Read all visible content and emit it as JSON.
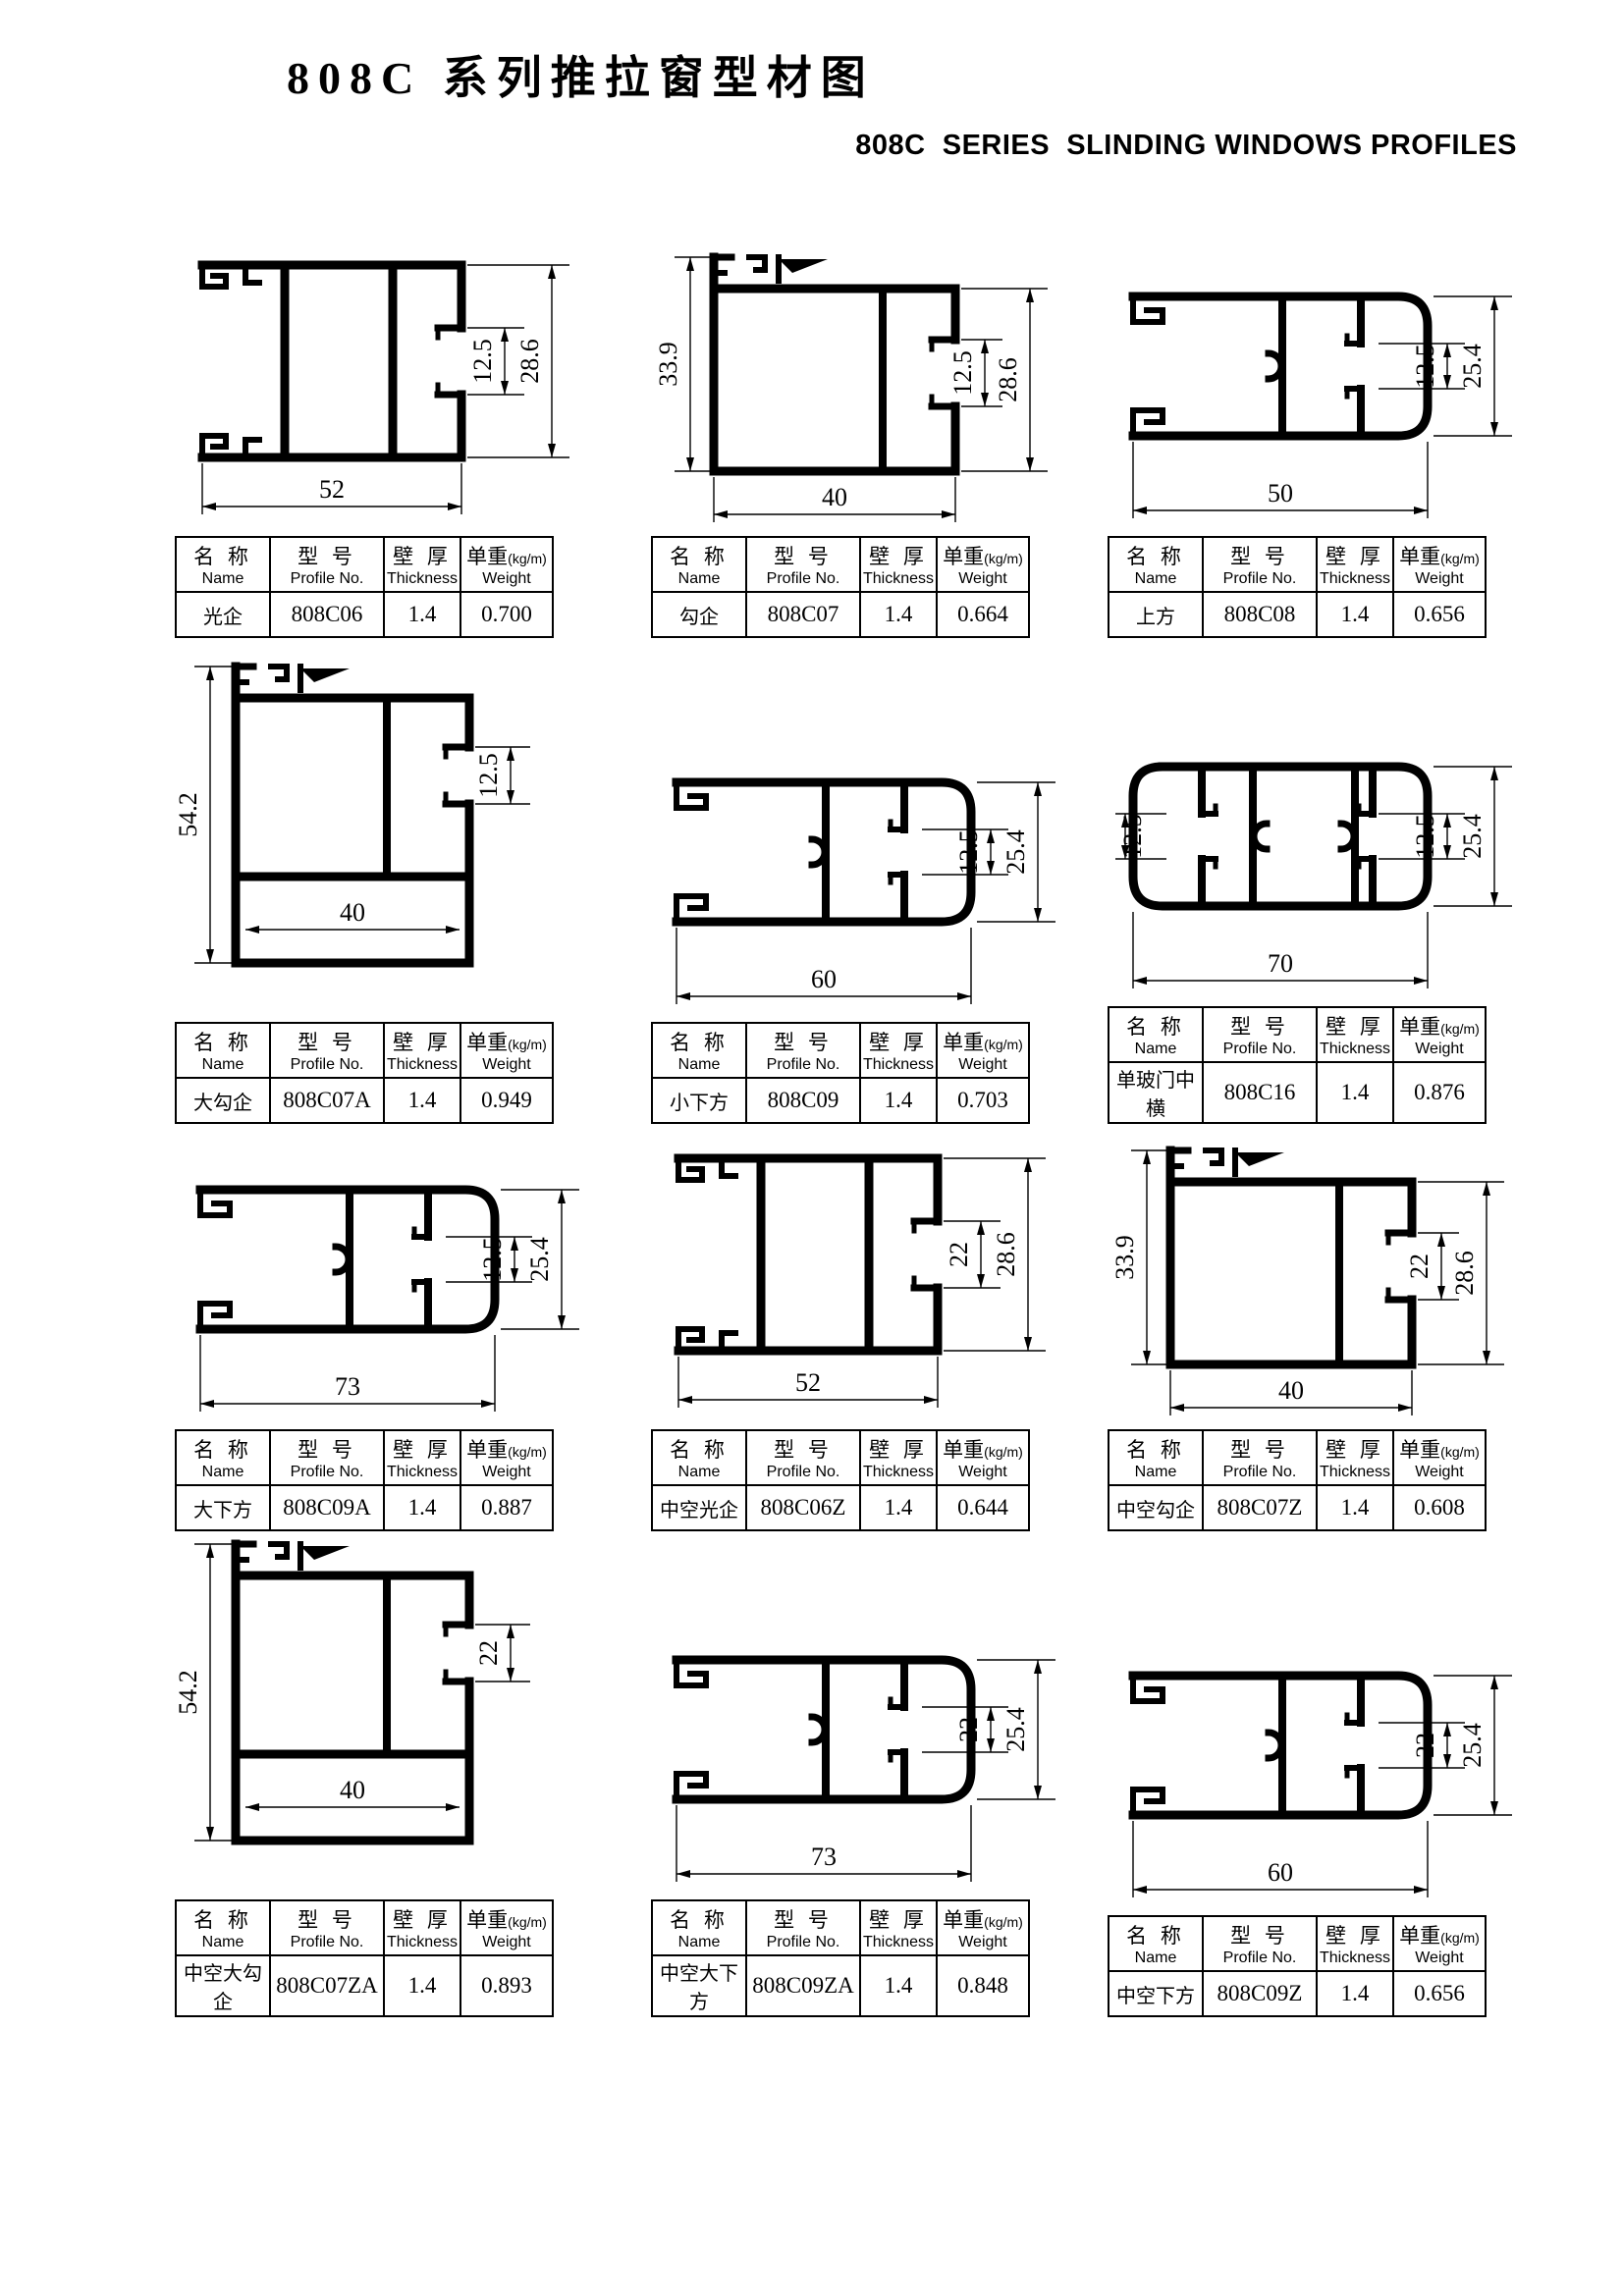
{
  "page": {
    "title": "808C 系列推拉窗型材图",
    "subtitle": "808C  SERIES  SLINDING WINDOWS PROFILES"
  },
  "table_headers": {
    "name_cn": "名 称",
    "name_en": "Name",
    "profile_cn": "型 号",
    "profile_en": "Profile No.",
    "thickness_cn": "壁 厚",
    "thickness_en": "Thickness",
    "weight_cn": "单重",
    "weight_unit": "(kg/m)",
    "weight_en": "Weight"
  },
  "profiles": [
    {
      "name": "光企",
      "profile_no": "808C06",
      "thickness": "1.4",
      "weight": "0.700",
      "shape": "frame",
      "dims": {
        "bottom": "52",
        "right_inner": "12.5",
        "right_outer": "28.6"
      }
    },
    {
      "name": "勾企",
      "profile_no": "808C07",
      "thickness": "1.4",
      "weight": "0.664",
      "shape": "hook-frame",
      "dims": {
        "left": "33.9",
        "bottom": "40",
        "right_inner": "12.5",
        "right_outer": "28.6"
      }
    },
    {
      "name": "上方",
      "profile_no": "808C08",
      "thickness": "1.4",
      "weight": "0.656",
      "shape": "rail",
      "dims": {
        "bottom": "50",
        "right_inner": "12.5",
        "right_outer": "25.4"
      }
    },
    {
      "name": "大勾企",
      "profile_no": "808C07A",
      "thickness": "1.4",
      "weight": "0.949",
      "shape": "tall-hook-frame",
      "dims": {
        "left": "54.2",
        "inner": "12.5",
        "bottom": "40"
      }
    },
    {
      "name": "小下方",
      "profile_no": "808C09",
      "thickness": "1.4",
      "weight": "0.703",
      "shape": "rail",
      "dims": {
        "bottom": "60",
        "right_inner": "12.5",
        "right_outer": "25.4"
      }
    },
    {
      "name": "单玻门中横",
      "profile_no": "808C16",
      "thickness": "1.4",
      "weight": "0.876",
      "shape": "rail-double",
      "dims": {
        "left": "12.5",
        "bottom": "70",
        "right_inner": "12.5",
        "right_outer": "25.4"
      }
    },
    {
      "name": "大下方",
      "profile_no": "808C09A",
      "thickness": "1.4",
      "weight": "0.887",
      "shape": "rail",
      "dims": {
        "bottom": "73",
        "right_inner": "12.5",
        "right_outer": "25.4"
      }
    },
    {
      "name": "中空光企",
      "profile_no": "808C06Z",
      "thickness": "1.4",
      "weight": "0.644",
      "shape": "frame",
      "dims": {
        "bottom": "52",
        "right_inner": "22",
        "right_outer": "28.6"
      }
    },
    {
      "name": "中空勾企",
      "profile_no": "808C07Z",
      "thickness": "1.4",
      "weight": "0.608",
      "shape": "hook-frame",
      "dims": {
        "left": "33.9",
        "bottom": "40",
        "right_inner": "22",
        "right_outer": "28.6"
      }
    },
    {
      "name": "中空大勾企",
      "profile_no": "808C07ZA",
      "thickness": "1.4",
      "weight": "0.893",
      "shape": "tall-hook-frame",
      "dims": {
        "left": "54.2",
        "inner": "22",
        "bottom": "40"
      }
    },
    {
      "name": "中空大下方",
      "profile_no": "808C09ZA",
      "thickness": "1.4",
      "weight": "0.848",
      "shape": "rail",
      "dims": {
        "bottom": "73",
        "right_inner": "22",
        "right_outer": "25.4"
      }
    },
    {
      "name": "中空下方",
      "profile_no": "808C09Z",
      "thickness": "1.4",
      "weight": "0.656",
      "shape": "rail",
      "dims": {
        "bottom": "60",
        "right_inner": "22",
        "right_outer": "25.4"
      }
    }
  ]
}
